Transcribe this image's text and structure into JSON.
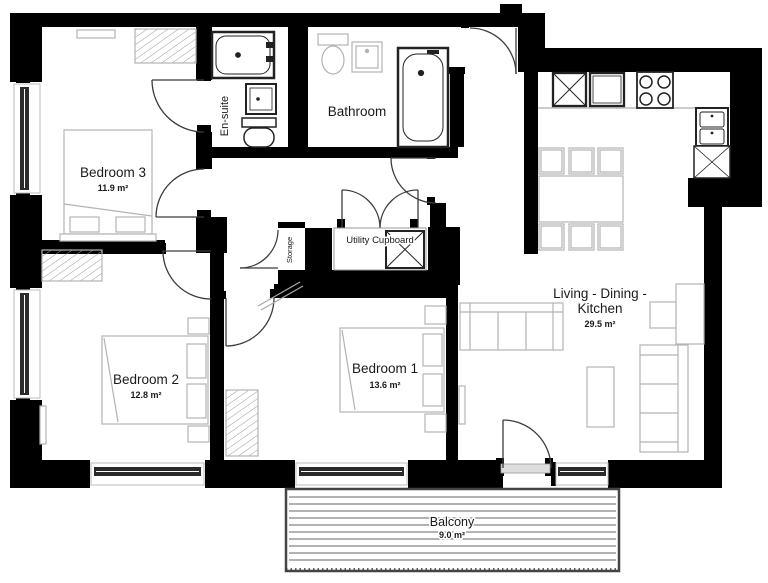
{
  "rooms": {
    "bedroom3": {
      "name": "Bedroom 3",
      "area": "11.9 m²"
    },
    "bedroom2": {
      "name": "Bedroom 2",
      "area": "12.8 m²"
    },
    "bedroom1": {
      "name": "Bedroom 1",
      "area": "13.6 m²"
    },
    "living": {
      "name_line1": "Living - Dining -",
      "name_line2": "Kitchen",
      "area": "29.5 m²"
    },
    "bathroom": {
      "name": "Bathroom"
    },
    "ensuite": {
      "name": "En-suite"
    },
    "storage": {
      "name": "Storage"
    },
    "utility": {
      "name": "Utility Cupboard"
    },
    "balcony": {
      "name": "Balcony",
      "area": "9.0 m²"
    }
  },
  "colors": {
    "wall": "#000000",
    "furniture_outline": "#b3b3b3",
    "fixture_outline": "#222222",
    "door_arc": "#3c3c3c",
    "glazing": "#2a2a2a",
    "balcony_decking": "#666666",
    "text": "#1a1a1a"
  }
}
